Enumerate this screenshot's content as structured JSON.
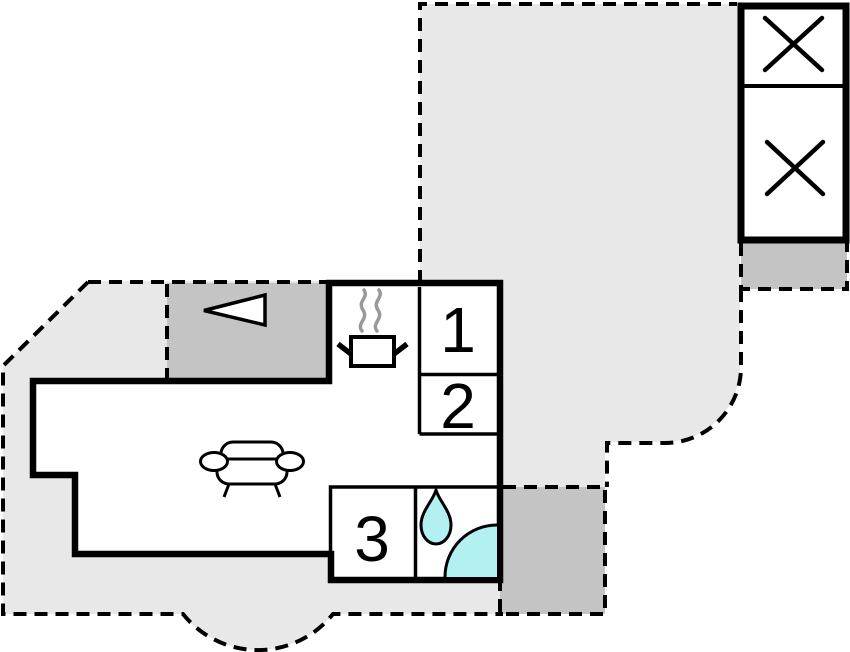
{
  "floorplan": {
    "rooms": [
      {
        "label": "1"
      },
      {
        "label": "2"
      },
      {
        "label": "3"
      }
    ],
    "colors": {
      "terrace": "#e8e8e8",
      "accent_gray": "#c4c4c4",
      "water": "#b2f0f2",
      "wall": "#000000",
      "steam": "#999999",
      "background": "#ffffff"
    },
    "icons": {
      "entrance_arrow": "entrance-arrow-icon",
      "stove_pot": "stove-pot-icon",
      "steam": "steam-icon",
      "sofa": "sofa-icon",
      "water_drop": "water-drop-icon",
      "shower": "shower-quarter-icon",
      "x_cross": "x-cross-icon"
    }
  }
}
